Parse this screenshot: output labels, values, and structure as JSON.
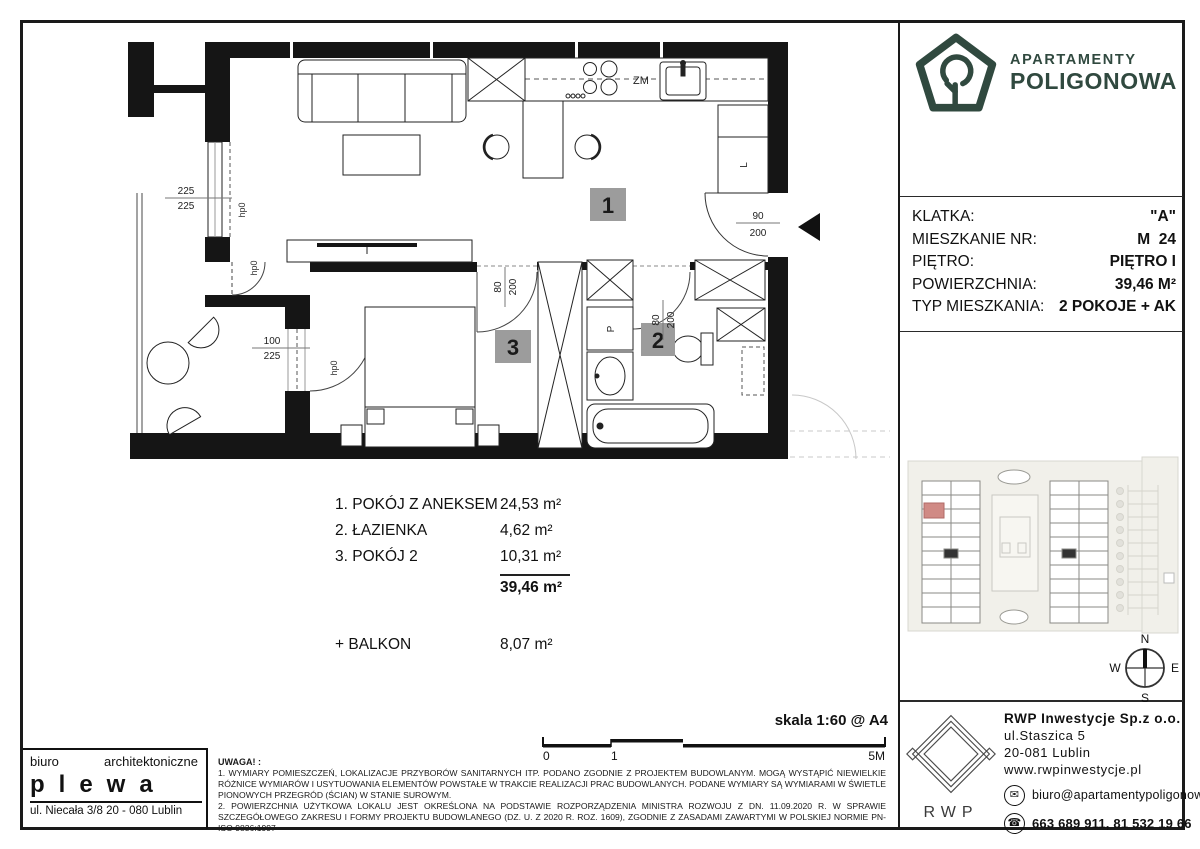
{
  "brand": {
    "line1": "APARTAMENTY",
    "line2": "POLIGONOWA",
    "color": "#30493f"
  },
  "details": {
    "rows": [
      {
        "label": "KLATKA:",
        "value": "\"A\""
      },
      {
        "label": "MIESZKANIE NR:",
        "value": "M  24"
      },
      {
        "label": "PIĘTRO:",
        "value": "PIĘTRO I"
      },
      {
        "label": "POWIERZCHNIA:",
        "value": "39,46 M²"
      },
      {
        "label": "TYP MIESZKANIA:",
        "value": "2 POKOJE + AK"
      }
    ]
  },
  "plan": {
    "rooms": {
      "r1": "1",
      "r2": "2",
      "r3": "3"
    },
    "labels": {
      "zm": "ZM",
      "l": "L",
      "p": "P",
      "hp": "hp0"
    },
    "dims": {
      "window": [
        "225",
        "225"
      ],
      "balcony": [
        "100",
        "225"
      ],
      "entrance": [
        "90",
        "200"
      ],
      "door": [
        "80",
        "200"
      ]
    }
  },
  "room_list": {
    "items": [
      {
        "name": "1. POKÓJ Z ANEKSEM",
        "area": "24,53 m²"
      },
      {
        "name": "2. ŁAZIENKA",
        "area": "4,62 m²"
      },
      {
        "name": "3. POKÓJ 2",
        "area": "10,31 m²"
      }
    ],
    "total": "39,46 m²",
    "balcony_name": "+ BALKON",
    "balcony_area": "8,07 m²"
  },
  "scale": {
    "text": "skala 1:60 @ A4",
    "t0": "0",
    "t1": "1",
    "t5": "5M"
  },
  "architect": {
    "word1": "biuro",
    "word2": "architektoniczne",
    "name": "plewa",
    "address": "ul. Niecała 3/8  20 - 080 Lublin"
  },
  "notes": {
    "title": "UWAGA! :",
    "n1": "1. WYMIARY POMIESZCZEŃ, LOKALIZACJE PRZYBORÓW SANITARNYCH ITP. PODANO ZGODNIE Z PROJEKTEM BUDOWLANYM. MOGĄ WYSTĄPIĆ NIEWIELKIE RÓŻNICE WYMIARÓW I USYTUOWANIA ELEMENTÓW POWSTAŁE W TRAKCIE REALIZACJI PRAC BUDOWLANYCH. PODANE WYMIARY SĄ WYMIARAMI W ŚWIETLE PIONOWYCH PRZEGRÓD (ŚCIAN) W STANIE SUROWYM.",
    "n2": "2. POWIERZCHNIA UŻYTKOWA LOKALU JEST OKREŚLONA NA PODSTAWIE ROZPORZĄDZENIA MINISTRA ROZWOJU Z DN. 11.09.2020 R. W SPRAWIE SZCZEGÓŁOWEGO ZAKRESU I FORMY PROJEKTU BUDOWLANEGO (DZ. U. Z 2020 R. ROZ. 1609), ZGODNIE Z ZASADAMI ZAWARTYMI W POLSKIEJ NORMIE PN-ISO 9836:1997"
  },
  "developer": {
    "name": "RWP Inwestycje Sp.z o.o.",
    "street": "ul.Staszica 5",
    "city": "20-081 Lublin",
    "web": "www.rwpinwestycje.pl",
    "email": "biuro@apartamentypoligonowa.pl",
    "phone": "663 689 911,  81 532 19 66",
    "logo": "RWP"
  },
  "compass": {
    "n": "N",
    "e": "E",
    "s": "S",
    "w": "W"
  }
}
